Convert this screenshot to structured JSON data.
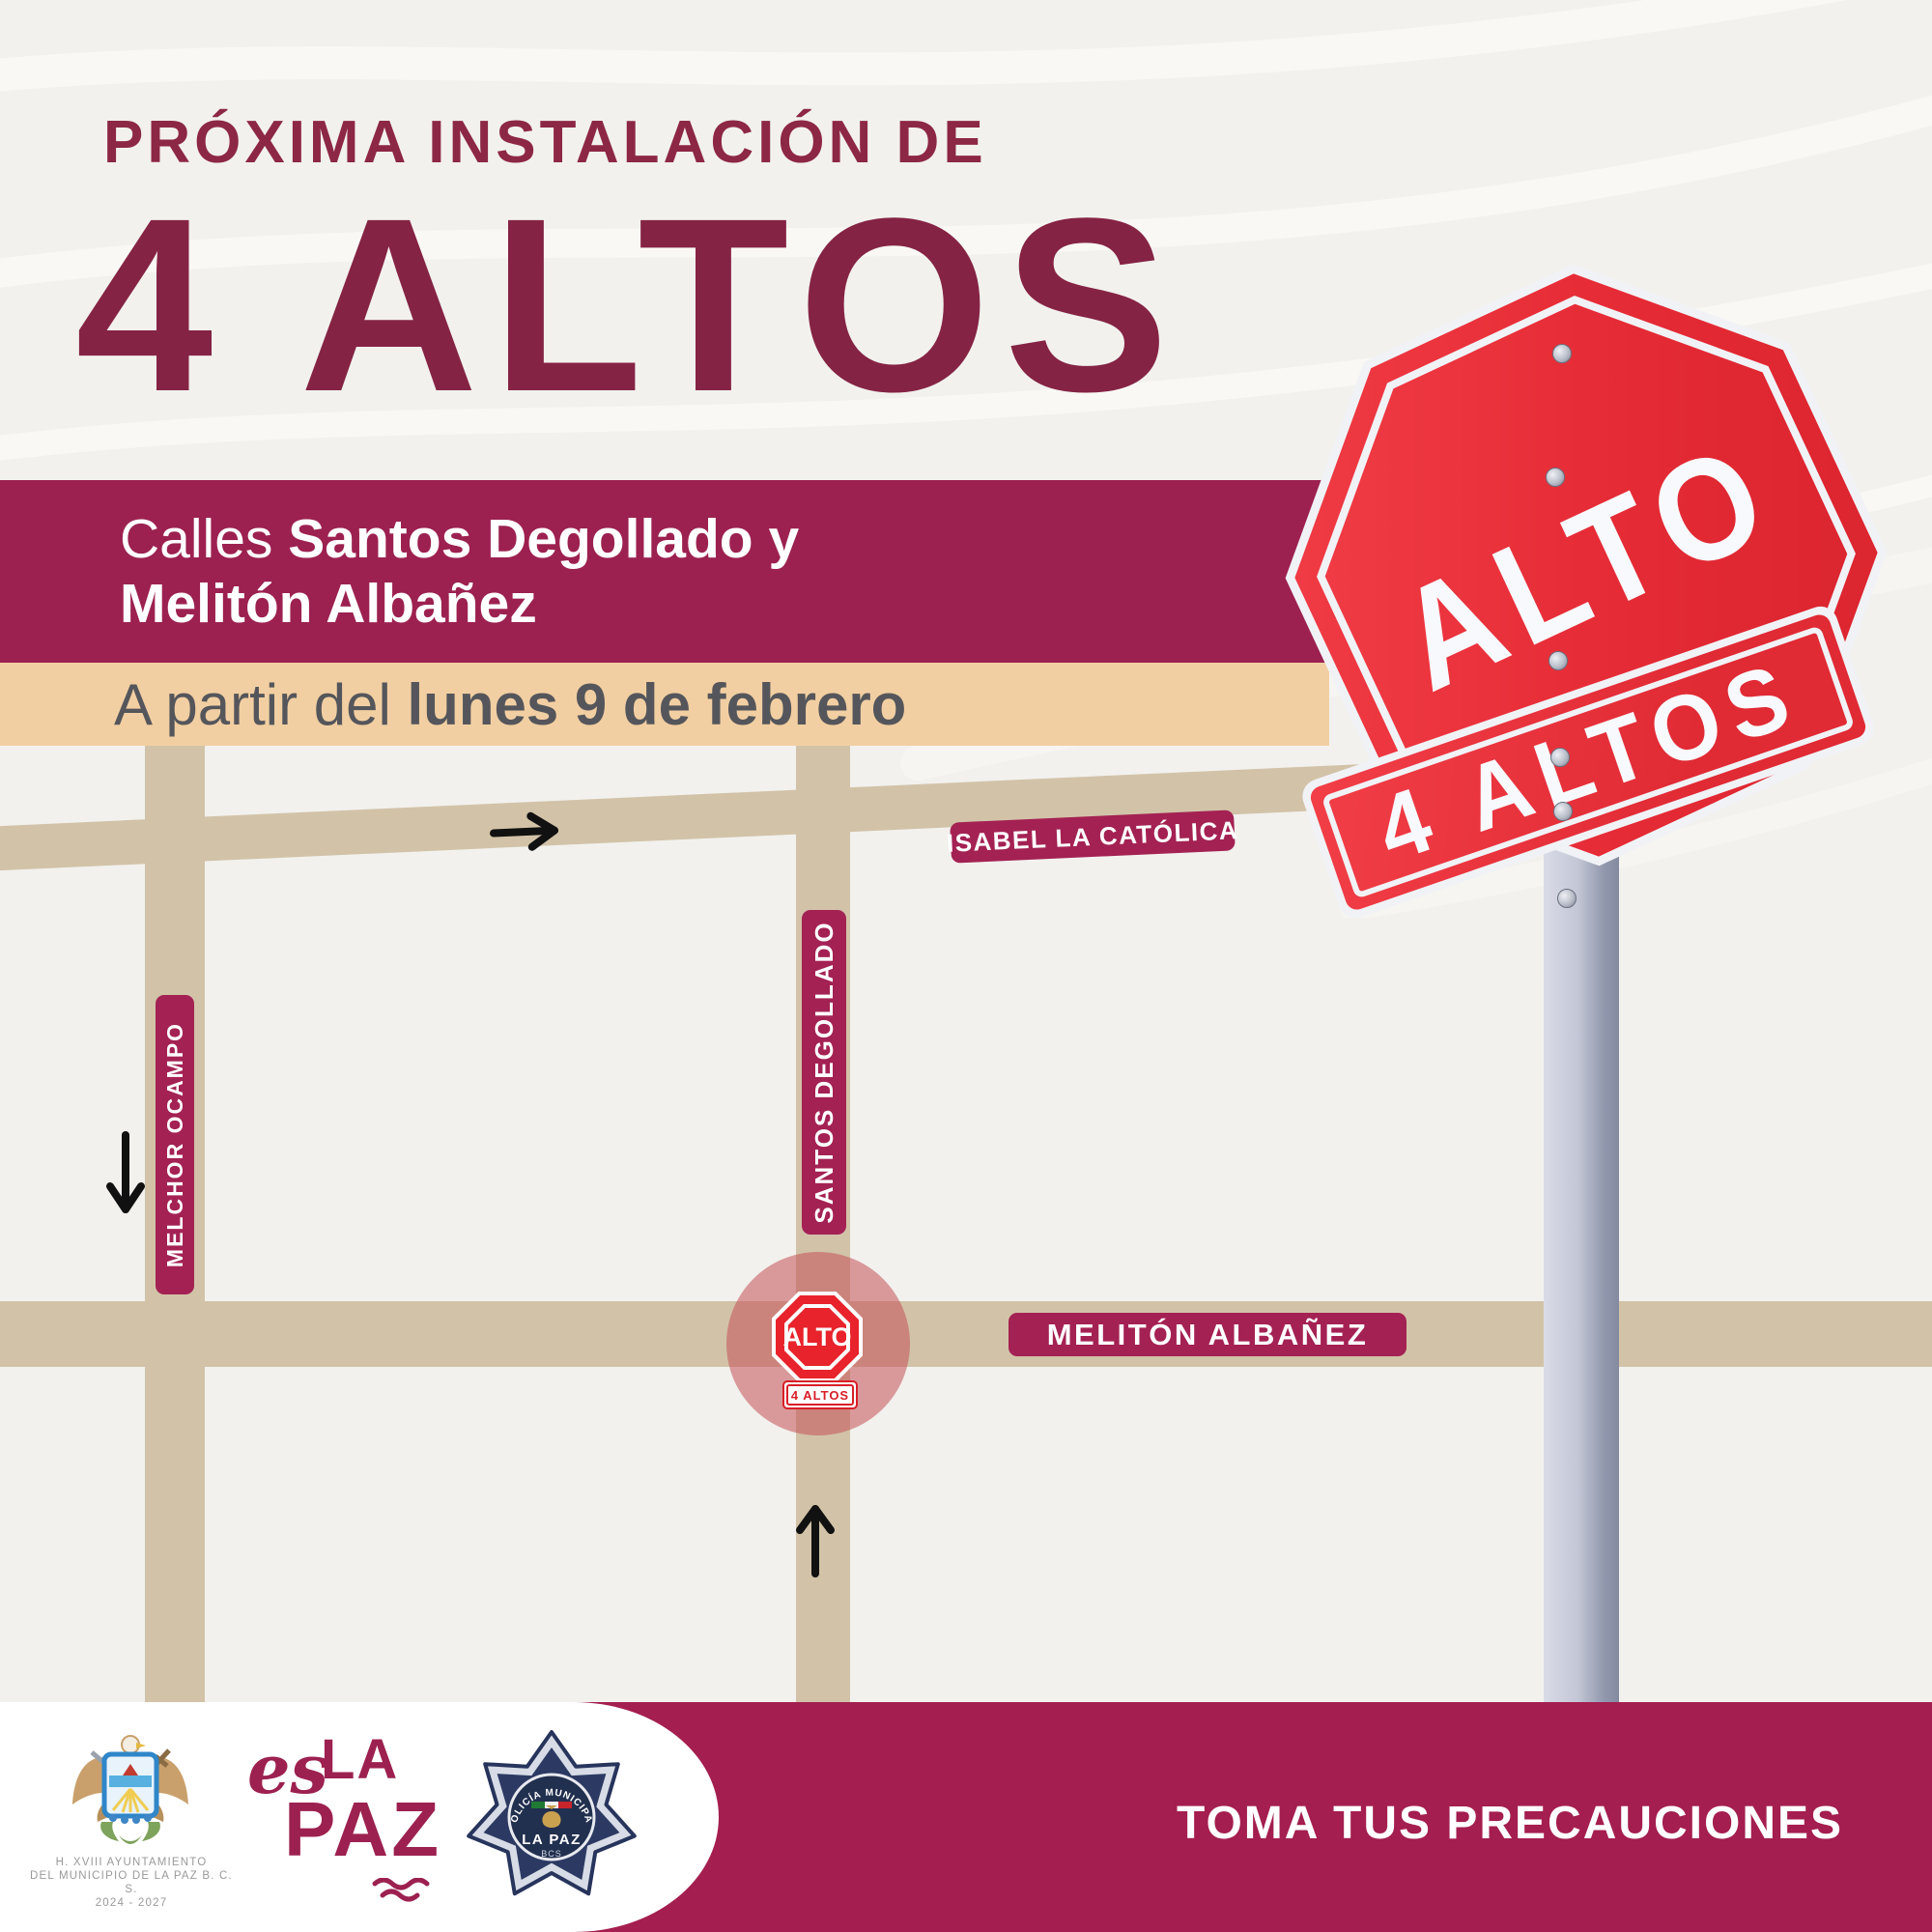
{
  "title": "PRÓXIMA INSTALACIÓN DE",
  "big_heading": "4 ALTOS",
  "banner": {
    "prefix": "Calles ",
    "line1_bold": "Santos Degollado y",
    "line2_bold": "Melitón Albañez"
  },
  "date_band": {
    "prefix": "A partir del ",
    "date_bold": "lunes 9 de febrero"
  },
  "map": {
    "streets": {
      "isabel": "ISABEL LA CATÓLICA",
      "santos": "SANTOS DEGOLLADO",
      "melchor": "MELCHOR OCAMPO",
      "meliton": "MELITÓN ALBAÑEZ"
    },
    "stop_icon": {
      "label": "ALTO",
      "sublabel": "4 ALTOS"
    }
  },
  "photo_signs": {
    "octagon_text": "ALTO",
    "rect_text": "4 ALTOS"
  },
  "footer": {
    "gov_line1": "H. XVIII AYUNTAMIENTO",
    "gov_line2": "DEL MUNICIPIO DE LA PAZ B. C. S.",
    "gov_line3": "2024 - 2027",
    "eslapaz": {
      "es": "es",
      "la": "LA",
      "paz": "PAZ"
    },
    "badge": {
      "arc": "POLICÍA MUNICIPAL",
      "city": "LA PAZ",
      "state": "BCS"
    },
    "warning": "TOMA TUS PRECAUCIONES"
  },
  "colors": {
    "maroon_dark": "#852345",
    "maroon_banner": "#9c2150",
    "maroon_footer": "#a41e4f",
    "pill": "#a42153",
    "tan_band": "#f2cfa2",
    "road": "#d2c3a8",
    "stop_red": "#e8232b",
    "photo_red": "#e52b35",
    "text_gray": "#55565b",
    "pole_gray": "#aab0c2",
    "background": "#f2f1ee"
  }
}
